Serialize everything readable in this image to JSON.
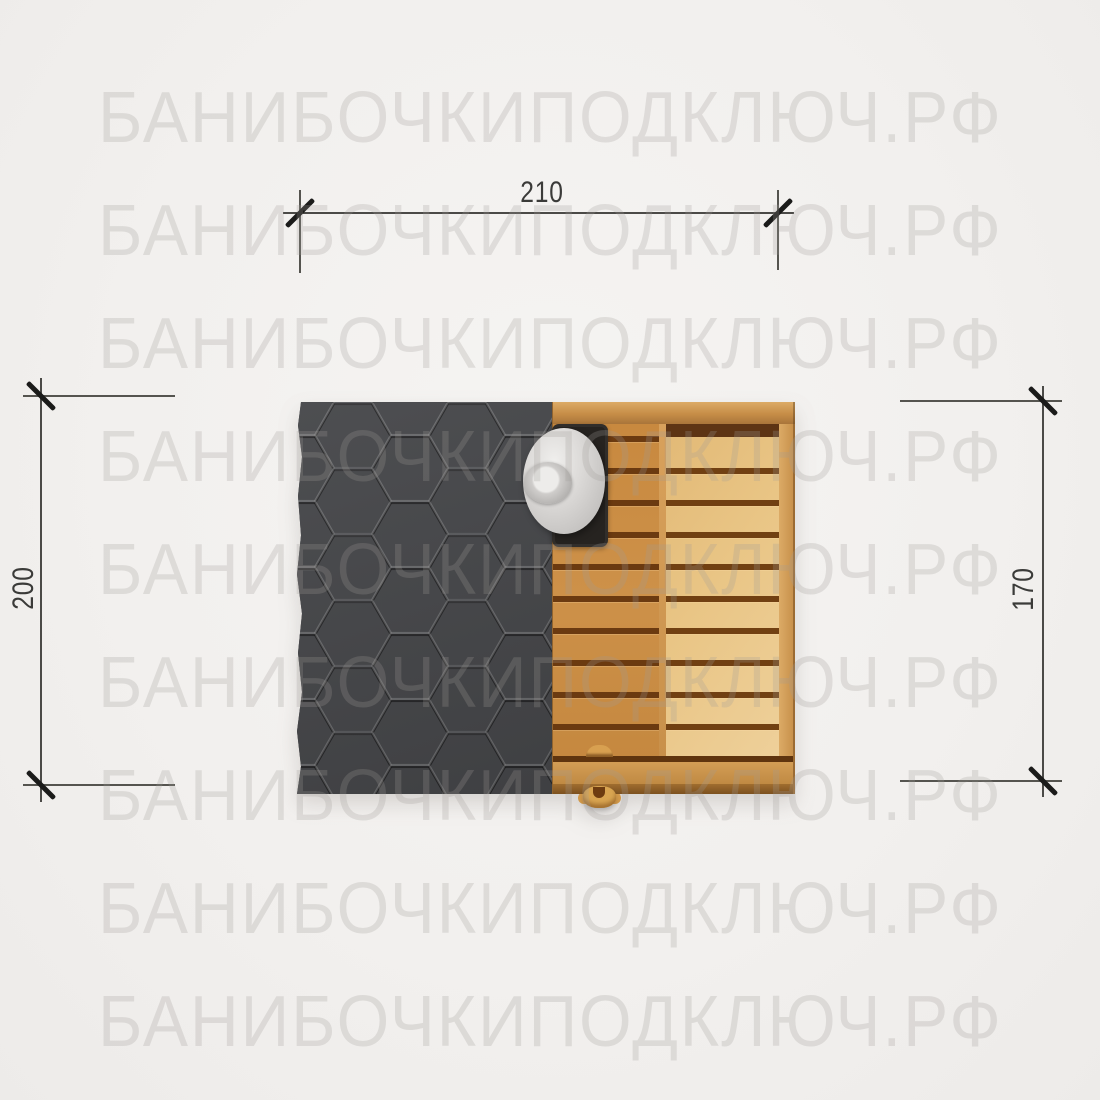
{
  "page": {
    "background_color": "#f2f0ee"
  },
  "watermark": {
    "text": "БАНИБОЧКИПОДКЛЮЧ.РФ",
    "row_count": 9,
    "first_row_center_y": 118,
    "row_spacing": 113,
    "color": "rgba(158,154,150,0.25)"
  },
  "dimensions": {
    "top": {
      "label": "210"
    },
    "left": {
      "label": "200"
    },
    "right": {
      "label": "170"
    }
  },
  "drawing": {
    "type": "sauna-top-plan",
    "roof": {
      "pattern": "hexagon-shingles",
      "color": "#46474a"
    },
    "deck": {
      "left_column": {
        "slat_color": "#cd9149",
        "gap_count": 11,
        "gap_start": 12,
        "gap_step": 32
      },
      "right_column": {
        "slat_color": "#e9c585",
        "gap_count": 10,
        "gap_start": 44,
        "gap_step": 32
      },
      "gap_color": "#6b3a10"
    },
    "chimney": {
      "base_color": "#262320",
      "cap_color": "#dbd9d7"
    },
    "handle": {
      "color": "#d9a551"
    }
  }
}
